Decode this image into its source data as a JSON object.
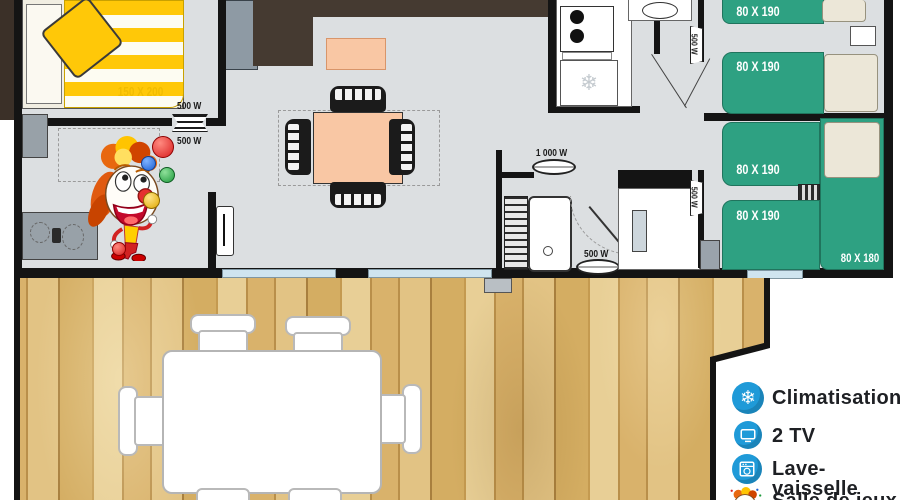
{
  "plan": {
    "bedroom_master": {
      "bed_label": "150 X 200"
    },
    "beds_single": [
      "80 X 190",
      "80 X 190",
      "80 X 190",
      "80 X 190"
    ],
    "bed_corner_label": "80 X 180",
    "heaters": {
      "living_top": "500 W",
      "living_bottom": "500 W",
      "hallway": "500 W",
      "bedroom2": "500 W",
      "bathroom_top": "1 000 W",
      "bathroom_bottom": "500 W"
    }
  },
  "legend": {
    "items": [
      {
        "icon": "snowflake-icon",
        "label": "Climatisation"
      },
      {
        "icon": "tv-icon",
        "label": "2 TV"
      },
      {
        "icon": "dishwasher-icon",
        "label": "Lave-vaisselle"
      },
      {
        "icon": "clown-icon",
        "label": "Salle de jeux"
      }
    ],
    "icon_color": "#1f9ad8"
  },
  "colors": {
    "bed_green": "#2ea182",
    "accent_yellow": "#ffc808",
    "peach": "#f9c7a4",
    "floor_gray": "#dcdfe1",
    "wood": "#d8b573",
    "legend_blue": "#1f9ad8"
  }
}
